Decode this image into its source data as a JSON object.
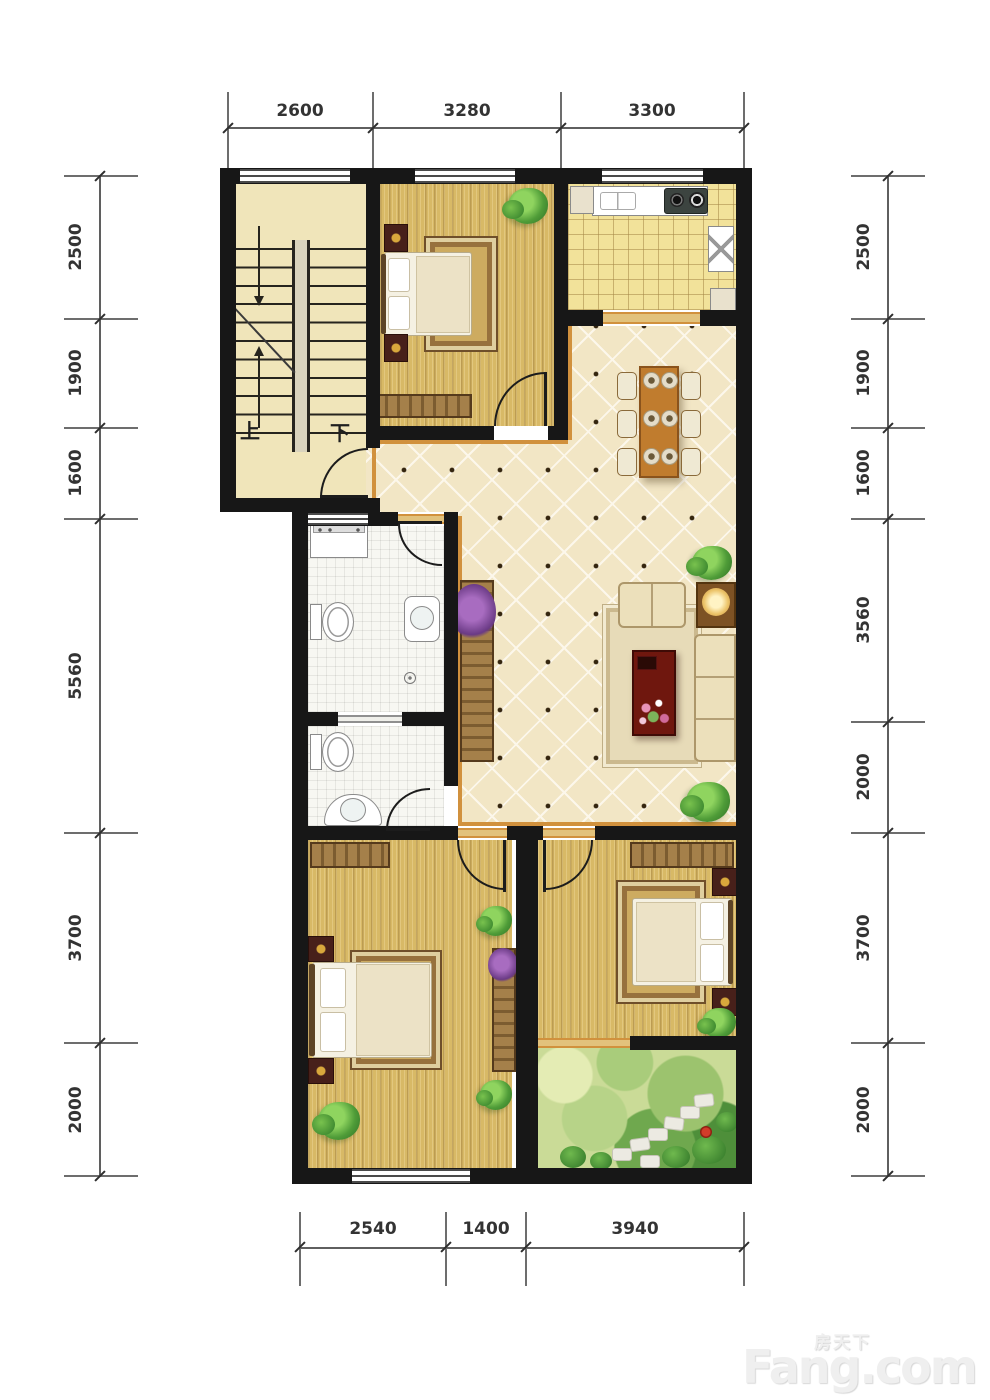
{
  "plan": {
    "type": "apartment-floor-plan",
    "units": "mm"
  },
  "dimensions": {
    "top": [
      "2600",
      "3280",
      "3300"
    ],
    "bottom": [
      "2540",
      "1400",
      "3940"
    ],
    "left": [
      "2500",
      "1900",
      "1600",
      "5560",
      "3700",
      "2000"
    ],
    "right": [
      "2500",
      "1900",
      "1600",
      "3560",
      "2000",
      "3700",
      "2000"
    ]
  },
  "stairs": {
    "up": "上",
    "down": "下"
  },
  "watermark": {
    "cn": "房天下",
    "en": "Fang.com"
  },
  "colors": {
    "wall": "#171717",
    "tile_floor": "#f2e6c5",
    "wood_floor": "#d8b966",
    "kitchen_floor": "#f2e29a",
    "bath_floor": "#f7f7f2",
    "garden": "#cadb97",
    "trim": "#d1913d",
    "dim_text": "#333333"
  }
}
